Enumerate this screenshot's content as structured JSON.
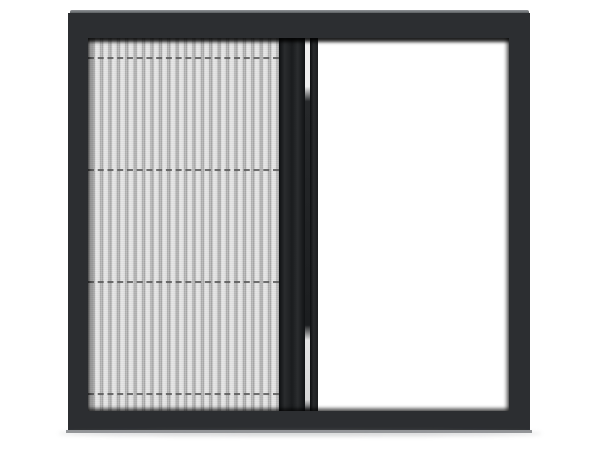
{
  "scene": {
    "description": "Product photo of a black aluminium sliding window frame; the left half is covered by a grey pleated (plisse) insect-mesh screen with four dashed horizontal support-cord lines, a black vertical handle bar and centre rail divide the frame, and the right half is open white space",
    "background_color": "#ffffff"
  },
  "colors": {
    "page_bg": "#ffffff",
    "frame": "#2c2e31",
    "frame_top_bevel": "#8f9296",
    "bottom_bevel": "#939598",
    "mesh_light": "#e7e7e7",
    "mesh_pleat_dark": "#a2a2a2",
    "cord_line": "#5a5a5a",
    "handle_bar": "#1a1c1e",
    "rail": "#1b1d1f",
    "track_gap_light": "#efefef",
    "open_pane": "#ffffff",
    "floor_shadow": "#9b9da0"
  },
  "screen": {
    "pleat_count": 23,
    "cord_line_count": 4,
    "left_panel": "pleated mesh screen extended",
    "right_panel": "open"
  }
}
